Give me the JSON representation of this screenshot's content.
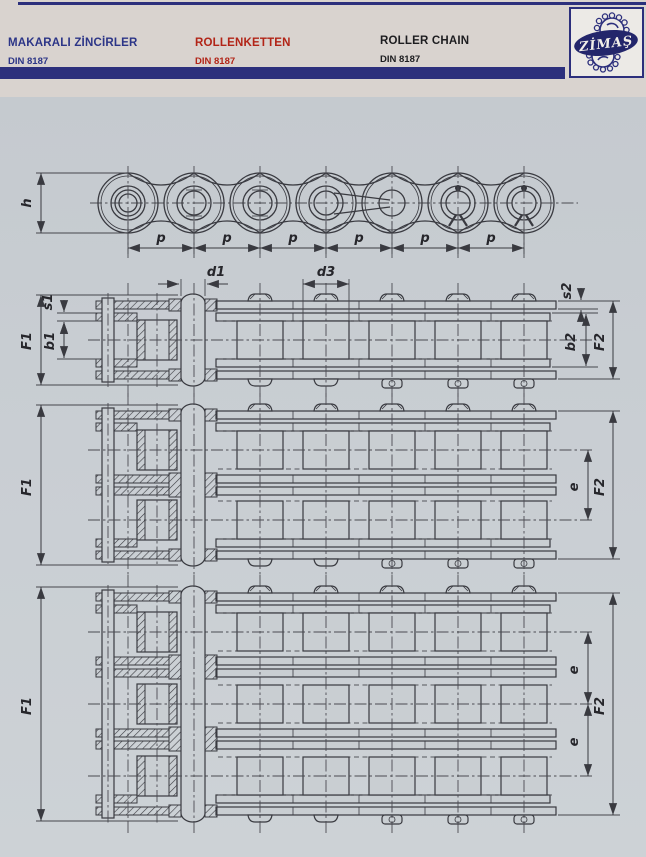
{
  "page": {
    "background_color": "#c9ced3",
    "header_background_color": "#d9d3cf",
    "accent_navy": "#2c2f7c",
    "accent_red": "#b22417"
  },
  "header": {
    "titles": [
      {
        "lang": "tr",
        "title": "MAKARALI ZİNCİRLER",
        "standard": "DIN 8187",
        "color": "#2c3587"
      },
      {
        "lang": "de",
        "title": "ROLLENKETTEN",
        "standard": "DIN 8187",
        "color": "#b22417"
      },
      {
        "lang": "en",
        "title": "ROLLER CHAIN",
        "standard": "DIN 8187",
        "color": "#1d1d20"
      }
    ],
    "logo": {
      "text": "ZİMAŞ"
    }
  },
  "drawing": {
    "labels": {
      "h": "h",
      "p": "p",
      "d1": "d1",
      "d3": "d3",
      "s1": "s1",
      "b1": "b1",
      "F1": "F1",
      "s2": "s2",
      "b2": "b2",
      "F2": "F2",
      "e": "e"
    },
    "views": [
      {
        "name": "side-elevation",
        "dimensions": [
          "h",
          "p",
          "p",
          "p",
          "p",
          "p",
          "p"
        ]
      },
      {
        "name": "simplex-cross-section",
        "dimensions": [
          "d1",
          "d3",
          "s1",
          "b1",
          "F1",
          "s2",
          "b2",
          "F2"
        ]
      },
      {
        "name": "duplex-cross-section",
        "dimensions": [
          "F1",
          "e",
          "F2"
        ]
      },
      {
        "name": "triplex-cross-section",
        "dimensions": [
          "F1",
          "e",
          "e",
          "F2"
        ]
      }
    ]
  }
}
